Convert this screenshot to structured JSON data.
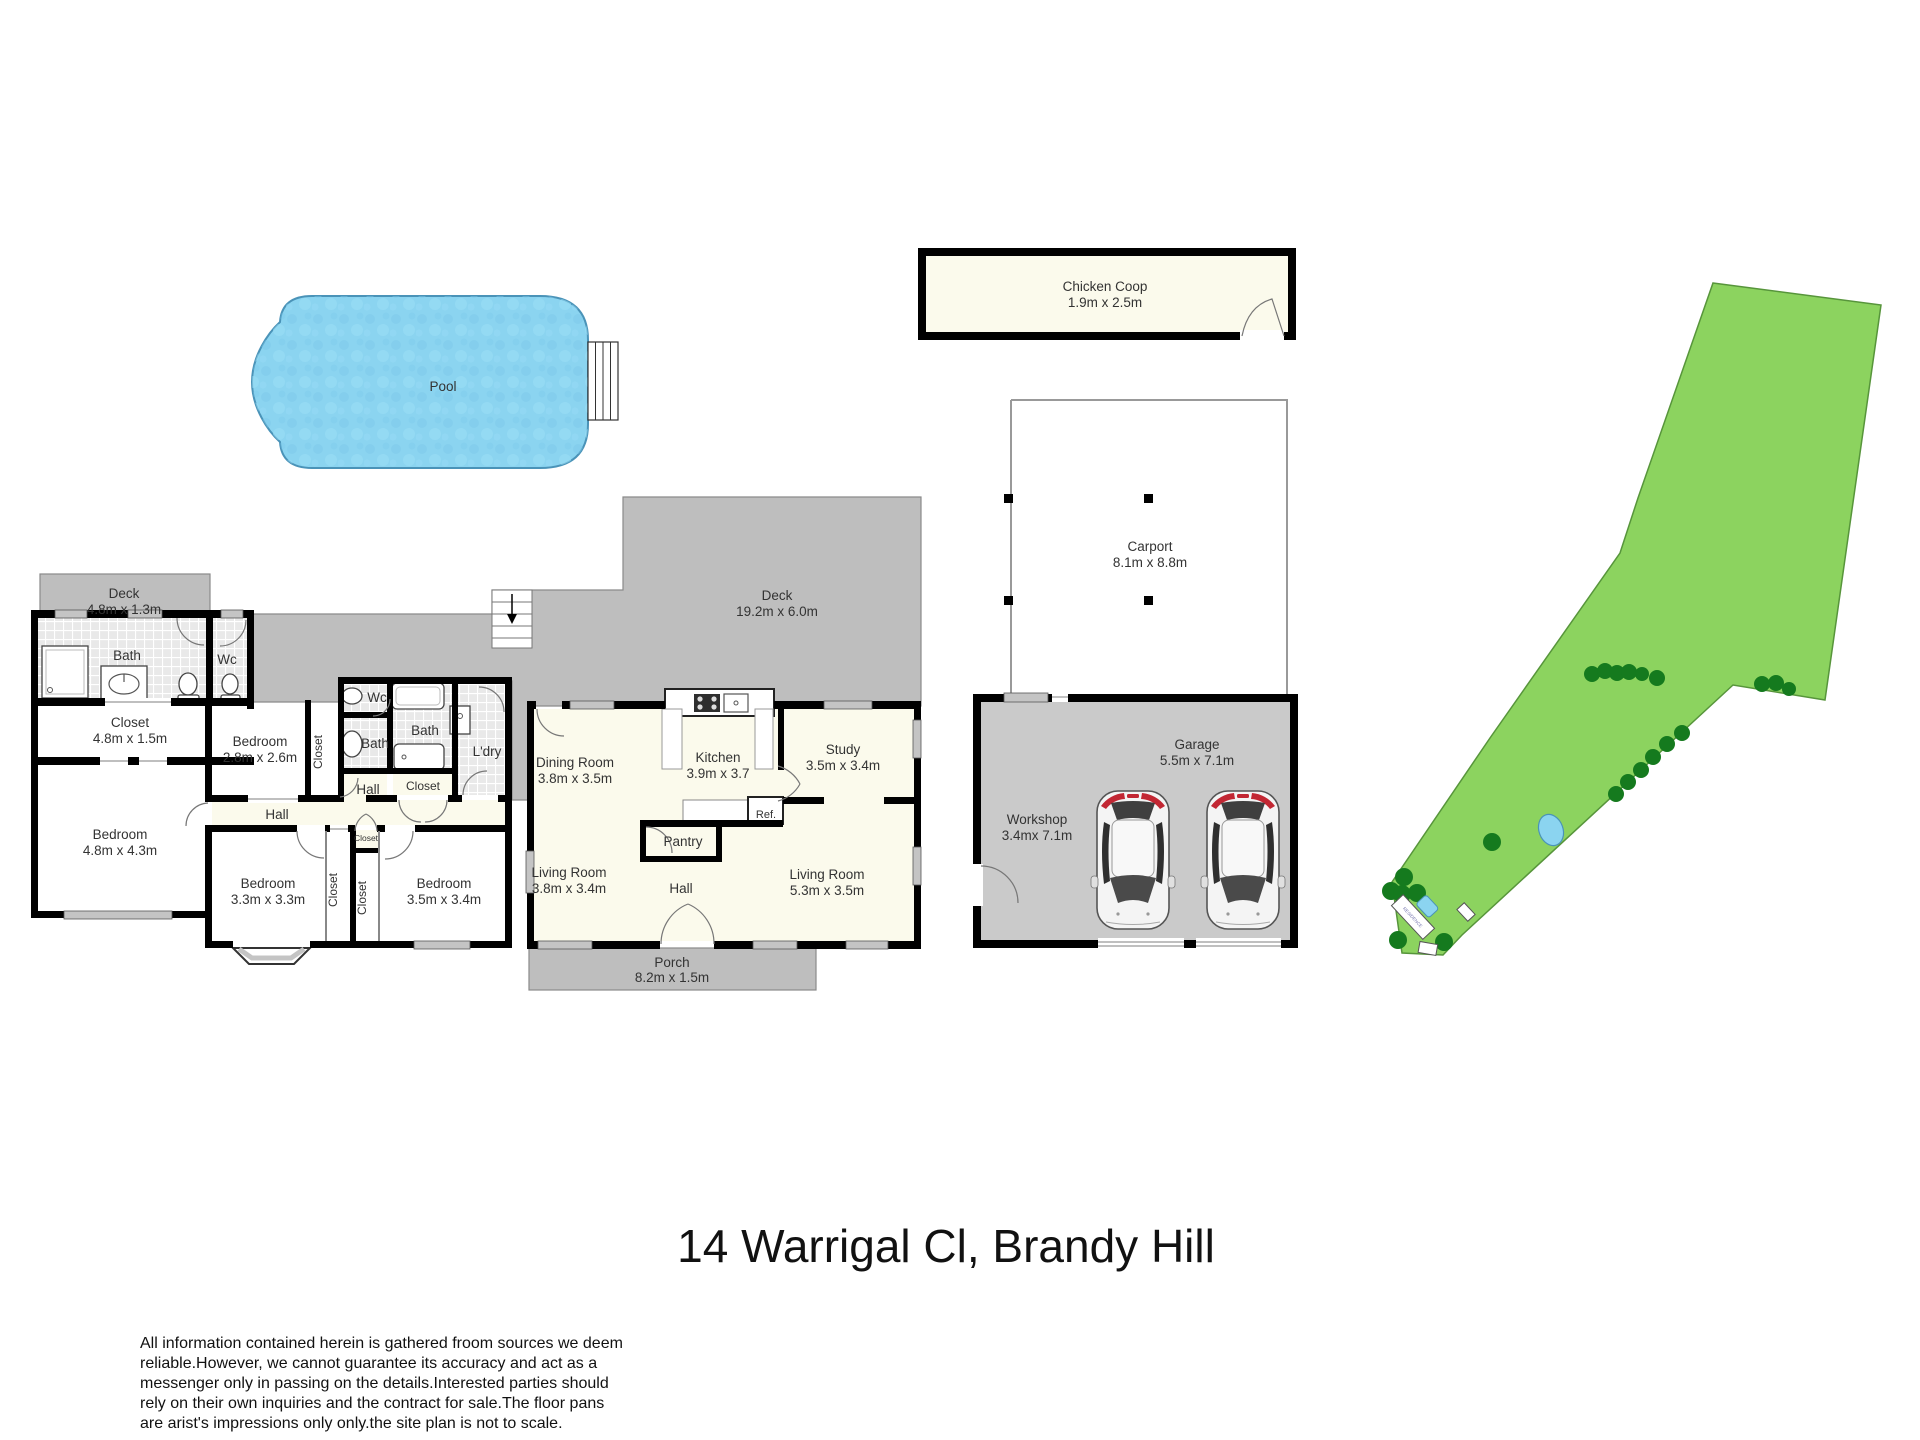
{
  "title": "14 Warrigal Cl, Brandy Hill",
  "disclaimer": [
    "All information contained herein is gathered froom sources we deem",
    "reliable.However, we cannot guarantee its accuracy and act as a",
    "messenger only in passing on the details.Interested parties should",
    "rely on their own inquiries and the contract for sale.The floor pans",
    "are arist's impressions only only.the site plan is not to scale."
  ],
  "colors": {
    "wall": "#000000",
    "window": "#C4C4C4",
    "deck_fill": "#BEBEBE",
    "room_cream": "#FBFAEC",
    "room_white": "#FFFFFF",
    "tile_base": "#E9E9E9",
    "pool_fill": "#8BD4F0",
    "pool_stroke": "#4A93B8",
    "garage_fill": "#CACACA",
    "site_fill": "#8CD35F",
    "site_stroke": "#57953B",
    "tree_fill": "#157A1E",
    "car_red": "#C22733"
  },
  "outdoor": {
    "pool": {
      "label": "Pool"
    },
    "chicken_coop": {
      "label": "Chicken Coop",
      "dims": "1.9m x 2.5m"
    },
    "carport": {
      "label": "Carport",
      "dims": "8.1m x 8.8m"
    },
    "garage": {
      "label": "Garage",
      "dims": "5.5m x 7.1m"
    },
    "workshop": {
      "label": "Workshop",
      "dims": "3.4mx 7.1m"
    },
    "residence": {
      "label": "RESIDENCE"
    }
  },
  "house": {
    "deck_small": {
      "label": "Deck",
      "dims": "4.8m x 1.3m"
    },
    "deck_large": {
      "label": "Deck",
      "dims": "19.2m x 6.0m"
    },
    "porch": {
      "label": "Porch",
      "dims": "8.2m x 1.5m"
    },
    "bath_left": {
      "label": "Bath"
    },
    "wc_left": {
      "label": "Wc"
    },
    "closet_long": {
      "label": "Closet",
      "dims": "4.8m x 1.5m"
    },
    "bedroom_a": {
      "label": "Bedroom",
      "dims": "2.8m x 2.6m"
    },
    "closet_a": {
      "label": "Closet"
    },
    "bedroom_b": {
      "label": "Bedroom",
      "dims": "4.8m x 4.3m"
    },
    "hall_left": {
      "label": "Hall"
    },
    "hall_mid": {
      "label": "Hall"
    },
    "wc_mid": {
      "label": "Wc"
    },
    "bath_mid_a": {
      "label": "Bath"
    },
    "bath_mid_b": {
      "label": "Bath"
    },
    "laundry": {
      "label": "L'dry"
    },
    "closet_mid": {
      "label": "Closet"
    },
    "closet_small": {
      "label": "Closet"
    },
    "bedroom_c": {
      "label": "Bedroom",
      "dims": "3.3m x 3.3m"
    },
    "closet_b": {
      "label": "Closet"
    },
    "closet_c": {
      "label": "Closet"
    },
    "bedroom_d": {
      "label": "Bedroom",
      "dims": "3.5m x 3.4m"
    },
    "dining": {
      "label": "Dining Room",
      "dims": "3.8m x 3.5m"
    },
    "kitchen": {
      "label": "Kitchen",
      "dims": "3.9m x 3.7"
    },
    "study": {
      "label": "Study",
      "dims": "3.5m x 3.4m"
    },
    "ref": {
      "label": "Ref."
    },
    "pantry": {
      "label": "Pantry"
    },
    "living_a": {
      "label": "Living Room",
      "dims": "3.8m x 3.4m"
    },
    "hall_right": {
      "label": "Hall"
    },
    "living_b": {
      "label": "Living Room",
      "dims": "5.3m x 3.5m"
    }
  }
}
